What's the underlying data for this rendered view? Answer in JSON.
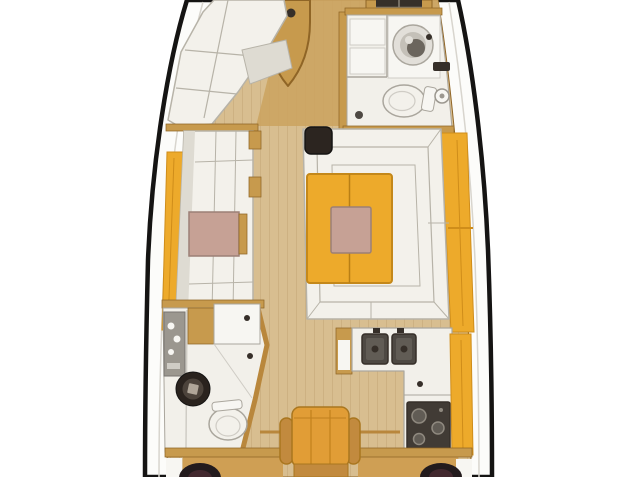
{
  "figure": {
    "kind": "sailboat-interior-floor-plan",
    "view": "top-down",
    "visible_text": ""
  },
  "rooms": {
    "bow": "Bow locker and deck hatch",
    "forward_cabin": "Forward cabin with V-berth",
    "forward_head": "Forward head with washbasin, toilet and shower",
    "saloon_port": "Port settee with side table",
    "saloon_starboard": "U-shaped settee with folding dining table",
    "galley": "Galley with double sink, stove and counters",
    "aft_head": "Aft head with shower panel, washbasin and toilet",
    "companionway": "Companionway seat",
    "aft_bulkhead": "Aft bulkhead with speakers"
  },
  "colors": {
    "background": "#ffffff",
    "hull_line": "#151413",
    "deck_white": "#fcfcfa",
    "deck_seam": "#d8d5ce",
    "floor_wood": "#d8be90",
    "floor_plank": "#c6a878",
    "cabin_floor": "#cba35f",
    "wood_trim": "#b9873c",
    "wood_trim_dark": "#8f6526",
    "cabinet_wood": "#c79a4d",
    "cabinet_front": "#cf9f54",
    "accent_yellow": "#edaa2b",
    "accent_yellow_dark": "#cf8d1a",
    "cushion_white": "#f3f1eb",
    "cushion_shadow": "#dedbd2",
    "cushion_line": "#b7b3a8",
    "fixture_white": "#f2f0ea",
    "fixture_bright": "#f7f6f2",
    "fixture_line": "#aaa69d",
    "soft_line": "#cfccc5",
    "panel_grey": "#9b978f",
    "panel_grey_dark": "#787570",
    "table_pink": "#c6a195",
    "pink_line": "#9c8076",
    "table_edge": "#c4881a",
    "table_seam": "#b97f15",
    "dark_fixture": "#362f29",
    "steel_dark": "#4e4943",
    "steel_mid": "#615c55",
    "burner_grey": "#8f897f",
    "stove_dark": "#413b35",
    "mast_dark": "#2c2520",
    "basin_light": "#e2dfd9",
    "basin_mid": "#c4c0b8",
    "basin_dark": "#6b655d",
    "basin_outer": "#2a231e",
    "basin_inner": "#4c433b",
    "basin_center": "#b0a699",
    "hatch_line": "#8a8478",
    "chair_orange": "#e19d36",
    "chair_wood": "#c28a3e",
    "chair_line": "#a9761f",
    "chair_seam": "#c0801d",
    "speaker_dark": "#231b1d",
    "speaker_inner": "#42282e"
  }
}
